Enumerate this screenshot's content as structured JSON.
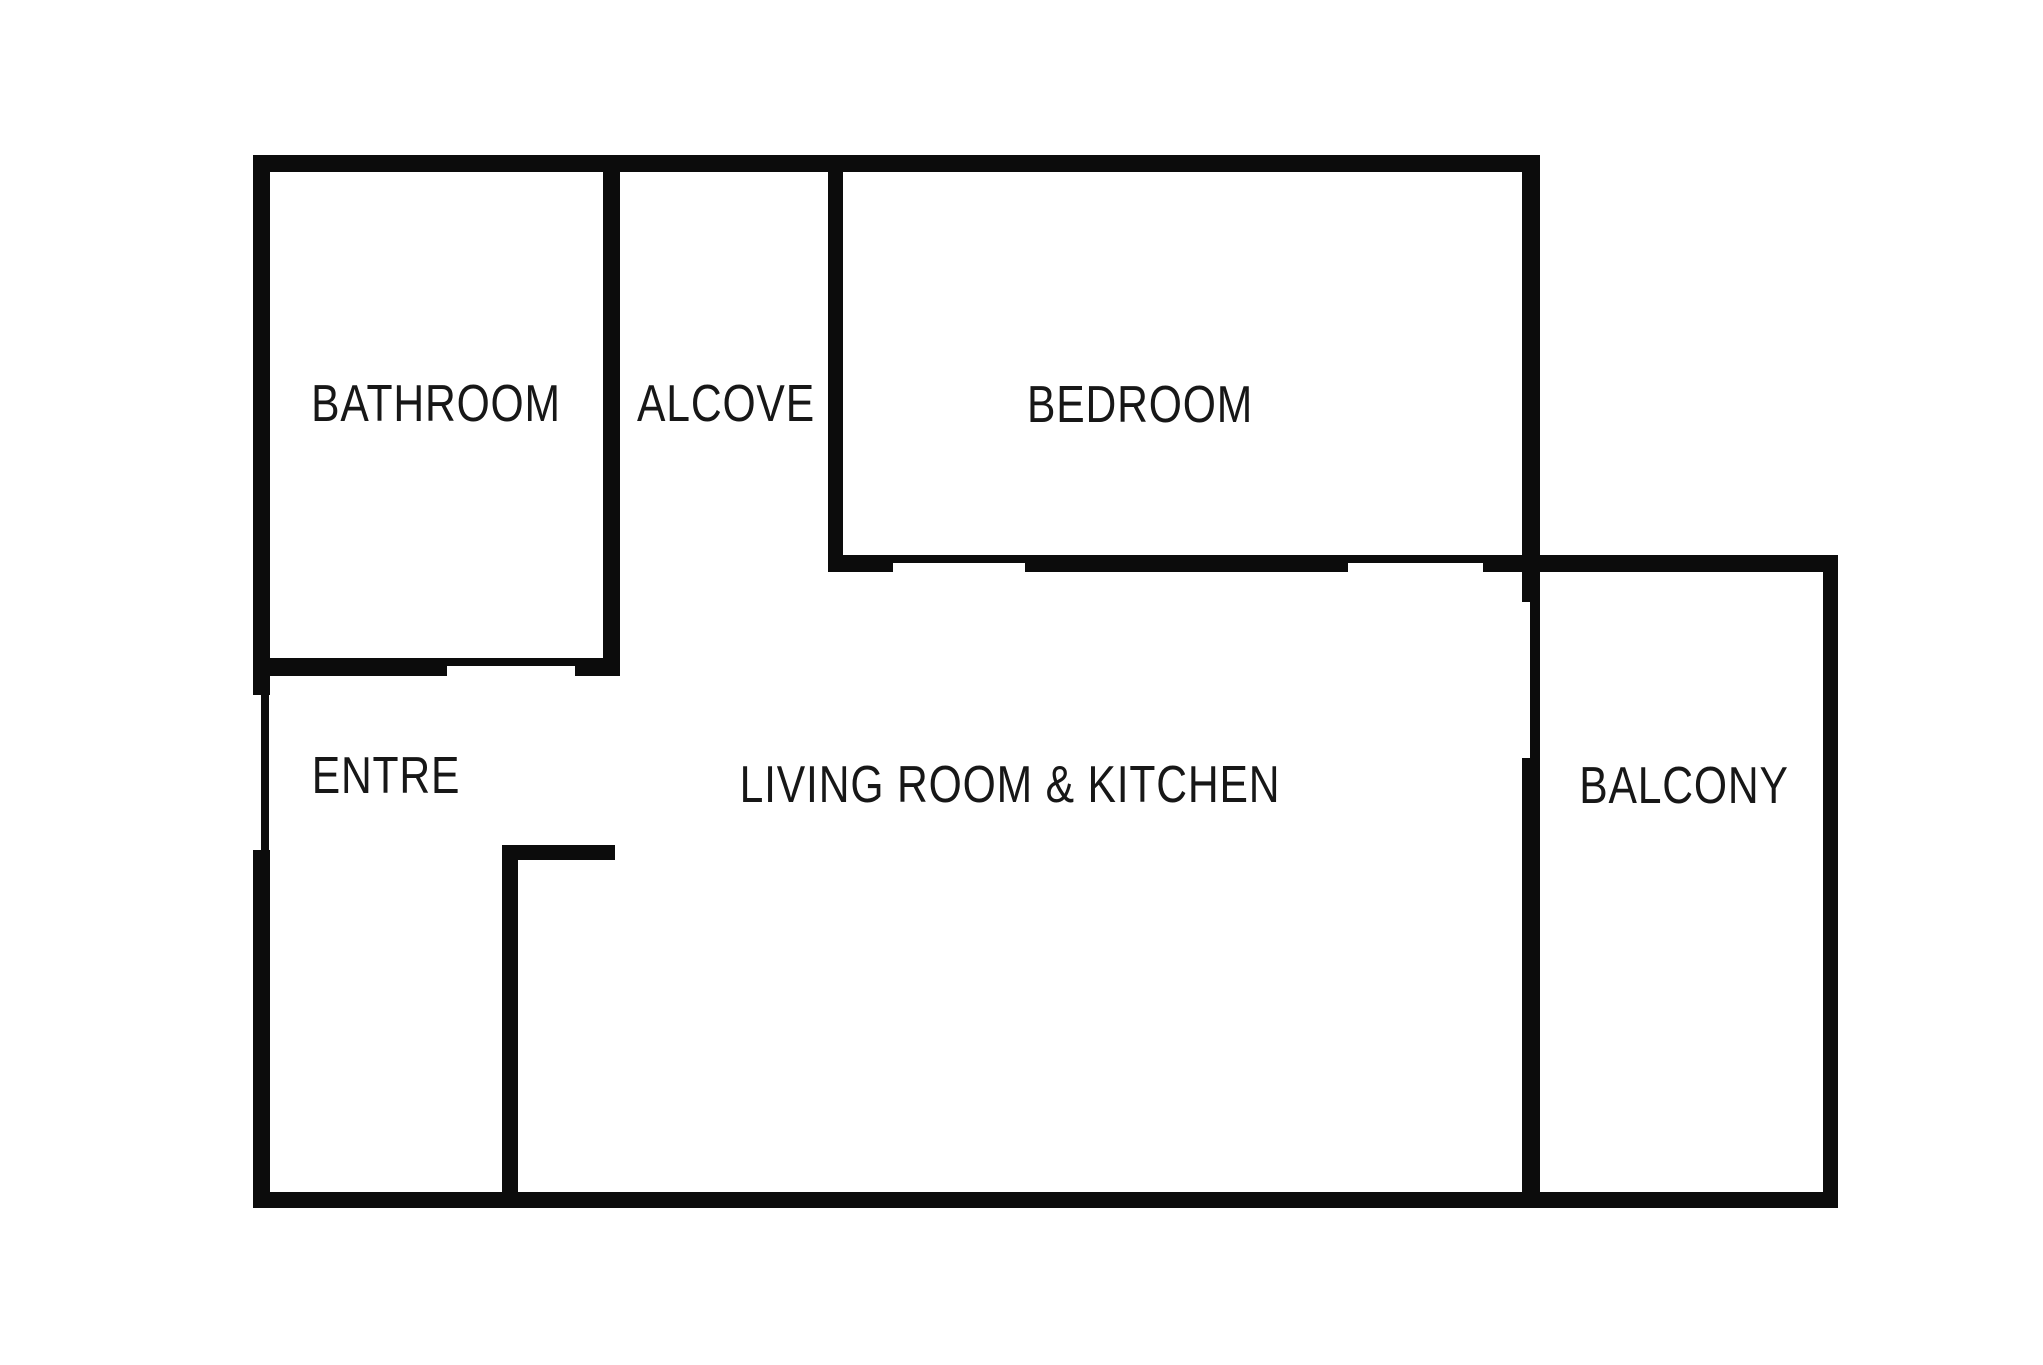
{
  "diagram": {
    "type": "floorplan",
    "background_color": "#ffffff",
    "wall_color": "#0c0c0c",
    "text_color": "#171717",
    "canvas": {
      "width": 2043,
      "height": 1365
    },
    "rooms": [
      {
        "id": "bathroom",
        "label": "BATHROOM",
        "label_x": 436,
        "label_y": 404
      },
      {
        "id": "alcove",
        "label": "ALCOVE",
        "label_x": 726,
        "label_y": 404
      },
      {
        "id": "bedroom",
        "label": "BEDROOM",
        "label_x": 1140,
        "label_y": 405
      },
      {
        "id": "entre",
        "label": "ENTRE",
        "label_x": 386,
        "label_y": 776
      },
      {
        "id": "living-room-kitchen",
        "label": "LIVING ROOM & KITCHEN",
        "label_x": 1010,
        "label_y": 785
      },
      {
        "id": "balcony",
        "label": "BALCONY",
        "label_x": 1684,
        "label_y": 786
      }
    ],
    "walls": [
      {
        "id": "outer-top-wall",
        "x": 253,
        "y": 155,
        "w": 1287,
        "h": 17
      },
      {
        "id": "outer-left-wall-upper",
        "x": 253,
        "y": 155,
        "w": 17,
        "h": 540
      },
      {
        "id": "entrance-door-opening",
        "x": 261,
        "y": 695,
        "w": 8,
        "h": 155
      },
      {
        "id": "outer-left-wall-lower",
        "x": 253,
        "y": 850,
        "w": 17,
        "h": 358
      },
      {
        "id": "outer-bottom-wall",
        "x": 253,
        "y": 1192,
        "w": 1585,
        "h": 16
      },
      {
        "id": "bathroom-south-wall-west",
        "x": 270,
        "y": 658,
        "w": 177,
        "h": 18
      },
      {
        "id": "bathroom-door-opening",
        "x": 447,
        "y": 658,
        "w": 128,
        "h": 8
      },
      {
        "id": "bathroom-south-wall-east",
        "x": 575,
        "y": 658,
        "w": 45,
        "h": 18
      },
      {
        "id": "bathroom-alcove-wall",
        "x": 603,
        "y": 172,
        "w": 17,
        "h": 504
      },
      {
        "id": "alcove-bedroom-wall",
        "x": 828,
        "y": 172,
        "w": 15,
        "h": 400
      },
      {
        "id": "bedroom-south-wall-west",
        "x": 828,
        "y": 555,
        "w": 65,
        "h": 17
      },
      {
        "id": "bedroom-door-opening",
        "x": 893,
        "y": 555,
        "w": 132,
        "h": 8
      },
      {
        "id": "bedroom-south-wall-mid",
        "x": 1025,
        "y": 555,
        "w": 323,
        "h": 17
      },
      {
        "id": "bedroom-south-window-opening",
        "x": 1348,
        "y": 555,
        "w": 135,
        "h": 8
      },
      {
        "id": "balcony-north-wall",
        "x": 1483,
        "y": 555,
        "w": 355,
        "h": 17
      },
      {
        "id": "bedroom-balcony-west-wall-upper",
        "x": 1522,
        "y": 172,
        "w": 18,
        "h": 430
      },
      {
        "id": "balcony-west-opening",
        "x": 1530,
        "y": 602,
        "w": 10,
        "h": 156
      },
      {
        "id": "balcony-west-wall-lower",
        "x": 1522,
        "y": 758,
        "w": 18,
        "h": 434
      },
      {
        "id": "balcony-east-wall",
        "x": 1823,
        "y": 555,
        "w": 15,
        "h": 653
      },
      {
        "id": "hall-partition-wall-vertical",
        "x": 502,
        "y": 845,
        "w": 16,
        "h": 347
      },
      {
        "id": "hall-partition-wall-horizontal",
        "x": 502,
        "y": 845,
        "w": 113,
        "h": 15
      }
    ]
  }
}
